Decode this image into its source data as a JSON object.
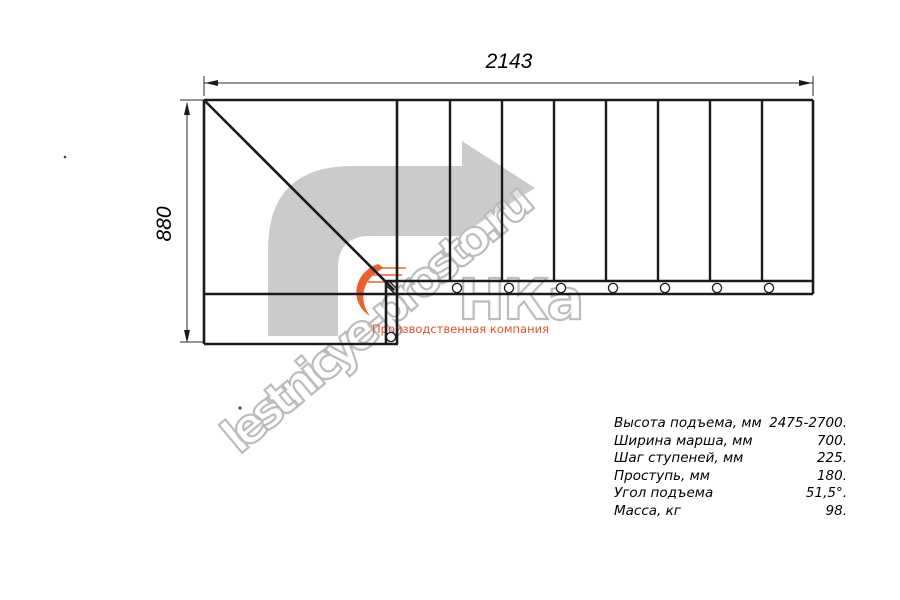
{
  "drawing": {
    "type": "staircase-top-view-plan",
    "width_dimension_mm": "2143",
    "height_dimension_mm": "880",
    "step_count_shown": 8
  },
  "watermark": {
    "site_text": "lestnicye-prosto.ru",
    "arrow_color": "#cbcbcb",
    "outline_color": "#bcbcbc"
  },
  "logo": {
    "text": "НКа",
    "tagline": "Производственная компания",
    "orange": "#e8622d"
  },
  "specs": {
    "rows": [
      {
        "label": "Высота подъема, мм",
        "value": "2475-2700."
      },
      {
        "label": "Ширина марша, мм",
        "value": "700."
      },
      {
        "label": "Шаг ступеней, мм",
        "value": "225."
      },
      {
        "label": "Проступь, мм",
        "value": "180."
      },
      {
        "label": "Угол подъема",
        "value": "51,5°."
      },
      {
        "label": "Масса, кг",
        "value": "98."
      }
    ]
  }
}
